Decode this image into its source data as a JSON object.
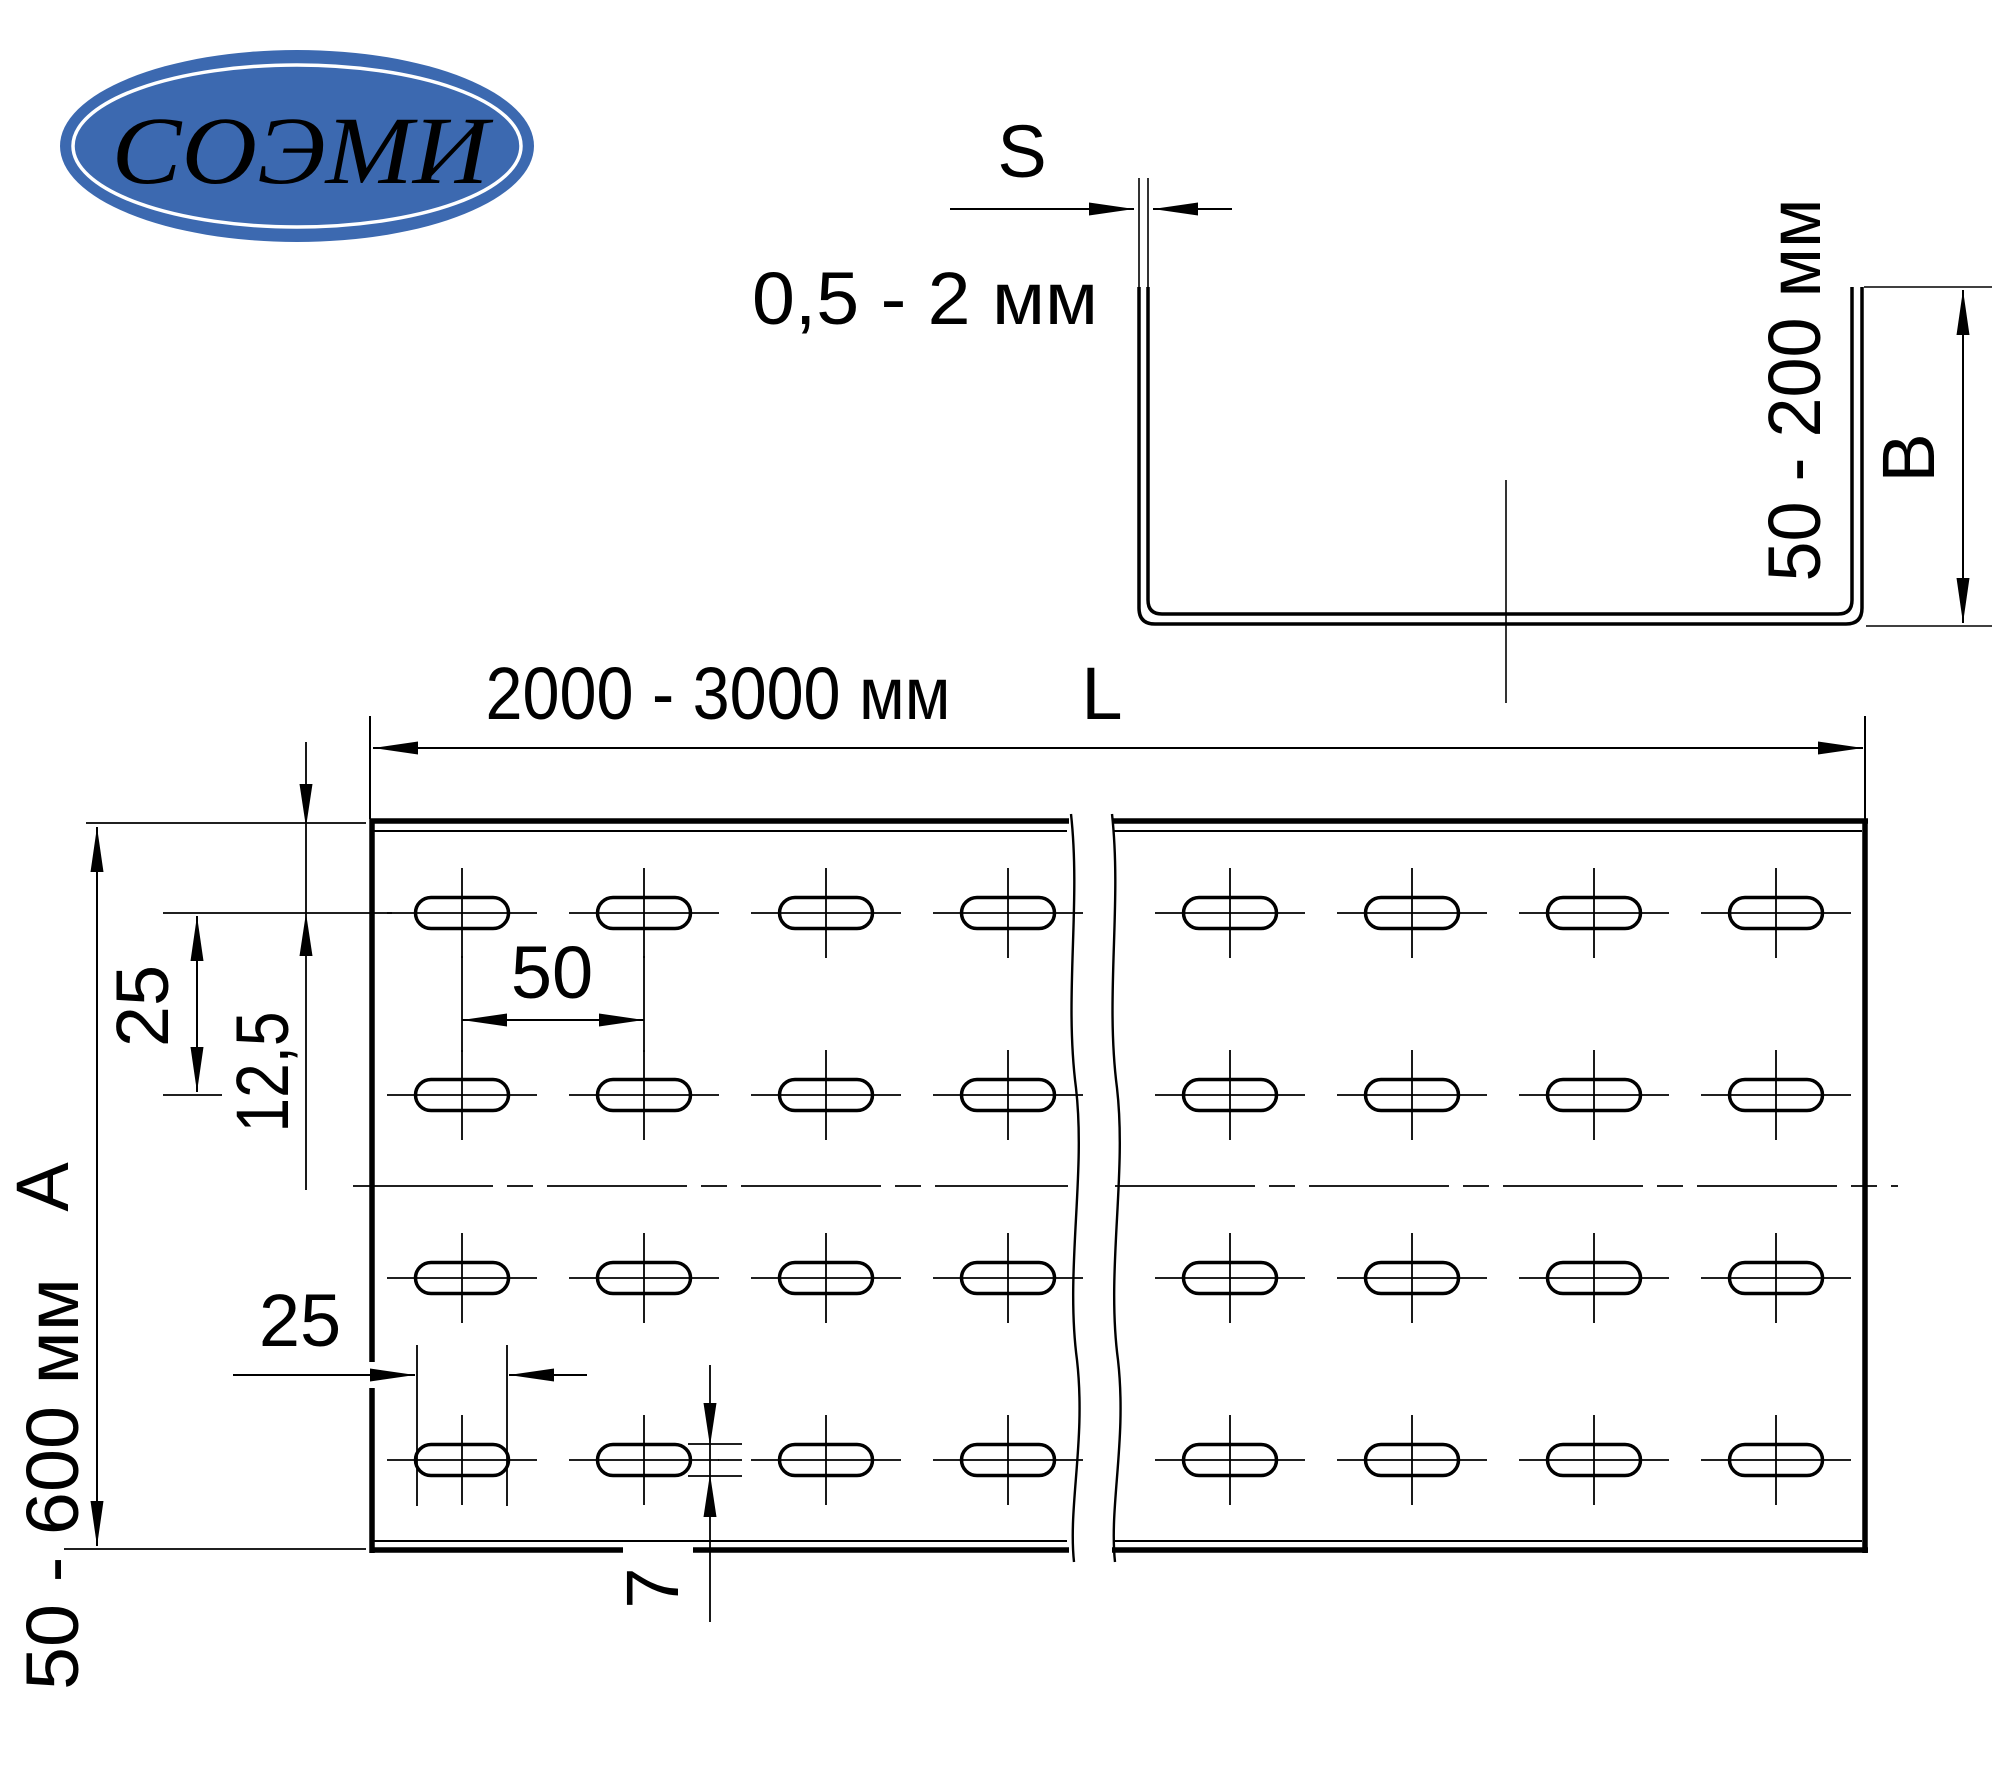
{
  "logo": {
    "text": "СОЭМИ",
    "bg_color": "#3c69b0",
    "text_color": "#ffffff"
  },
  "colors": {
    "line_color": "#000000",
    "background": "#ffffff"
  },
  "side_view": {
    "thickness_label": "S",
    "thickness_value": "0,5 - 2 мм",
    "height_value": "50 - 200 мм",
    "height_label": "B"
  },
  "top_view": {
    "length_value": "2000 - 3000 мм",
    "length_label": "L",
    "row_pitch": "25",
    "first_row_offset": "12,5",
    "column_pitch": "50",
    "slot_length": "25",
    "slot_width": "7",
    "width_label": "A",
    "width_value": "50 - 600 мм"
  },
  "drawing": {
    "slot": {
      "w": 93,
      "h": 31,
      "rx": 15.5
    },
    "rows_y": [
      913,
      1095,
      1278,
      1460
    ],
    "cols_left_x": [
      462,
      644,
      826,
      1008
    ],
    "cols_right_x": [
      1230,
      1412,
      1594,
      1776
    ]
  }
}
